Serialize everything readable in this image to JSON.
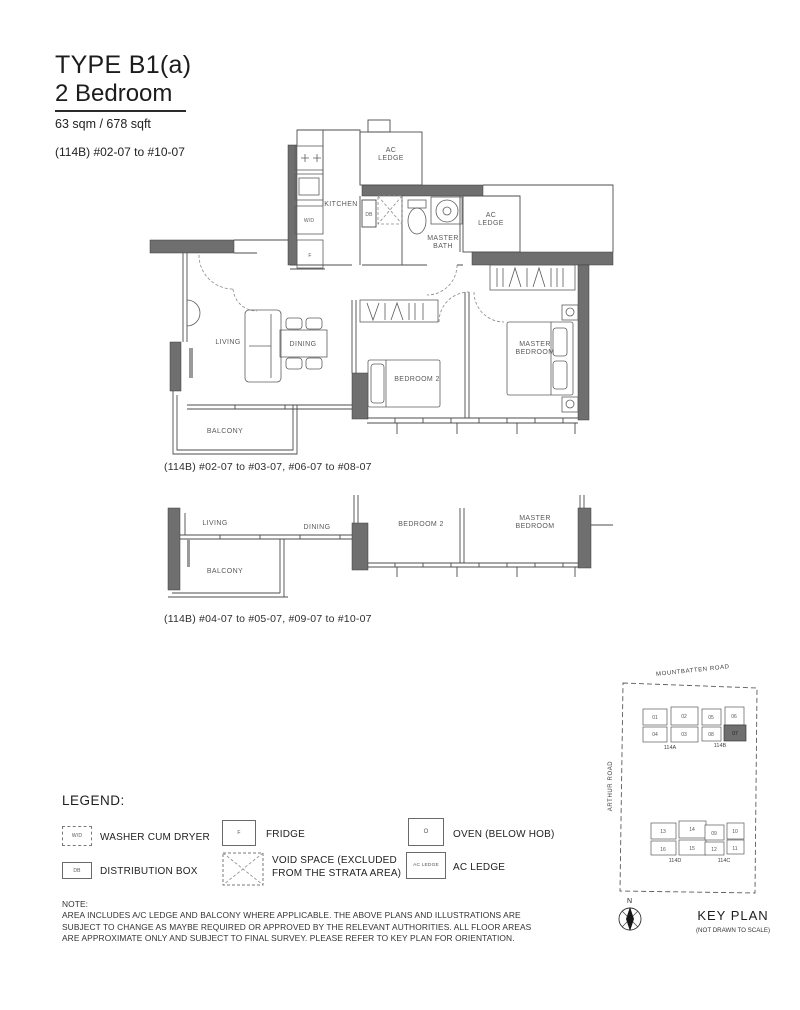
{
  "header": {
    "type_title": "TYPE B1(a)",
    "subtitle": "2 Bedroom",
    "area": "63 sqm / 678 sqft",
    "units": "(114B) #02-07 to #10-07"
  },
  "plan_main": {
    "labels": {
      "kitchen": "KITCHEN",
      "ac_ledge_top": "AC\nLEDGE",
      "master_bath": "MASTER\nBATH",
      "ac_ledge_right": "AC\nLEDGE",
      "living": "LIVING",
      "dining": "DINING",
      "bedroom2": "BEDROOM 2",
      "master_bedroom": "MASTER\nBEDROOM",
      "balcony": "BALCONY"
    },
    "fixtures": {
      "wd": "W/D",
      "fridge": "F",
      "db": "DB"
    },
    "caption": "(114B) #02-07 to #03-07, #06-07 to #08-07"
  },
  "plan_alt": {
    "labels": {
      "living": "LIVING",
      "dining": "DINING",
      "bedroom2": "BEDROOM 2",
      "master_bedroom": "MASTER\nBEDROOM",
      "balcony": "BALCONY"
    },
    "caption": "(114B) #04-07 to #05-07, #09-07 to #10-07"
  },
  "legend": {
    "title": "LEGEND:",
    "items": [
      {
        "symbol": "W/D",
        "label": "WASHER CUM DRYER"
      },
      {
        "symbol": "F",
        "label": "FRIDGE"
      },
      {
        "symbol": "O",
        "label": "OVEN (BELOW HOB)"
      },
      {
        "symbol": "DB",
        "label": "DISTRIBUTION BOX"
      },
      {
        "symbol": "",
        "label": "VOID SPACE (EXCLUDED\nFROM THE STRATA AREA)"
      },
      {
        "symbol": "AC LEDGE",
        "label": "AC LEDGE"
      }
    ]
  },
  "note": {
    "heading": "NOTE:",
    "body": "AREA INCLUDES A/C LEDGE AND BALCONY WHERE APPLICABLE. THE ABOVE PLANS AND ILLUSTRATIONS ARE\nSUBJECT TO CHANGE AS MAYBE REQUIRED OR APPROVED BY THE RELEVANT AUTHORITIES. ALL FLOOR AREAS\nARE APPROXIMATE ONLY AND SUBJECT TO FINAL SURVEY. PLEASE REFER TO KEY PLAN FOR ORIENTATION."
  },
  "key_plan": {
    "road_top": "MOUNTBATTEN ROAD",
    "road_left": "ARTHUR ROAD",
    "compass_n": "N",
    "title": "KEY PLAN",
    "subtitle": "(NOT DRAWN TO SCALE)",
    "highlighted_unit": "07",
    "blocks": [
      {
        "name": "114A",
        "units": [
          "01",
          "02",
          "04",
          "03"
        ]
      },
      {
        "name": "114B",
        "units": [
          "05",
          "06",
          "08",
          "07"
        ]
      },
      {
        "name": "114D",
        "units": [
          "13",
          "14",
          "16",
          "15"
        ]
      },
      {
        "name": "114C",
        "units": [
          "09",
          "10",
          "12",
          "11"
        ]
      }
    ]
  },
  "colors": {
    "wall": "#6f6f6f",
    "line": "#4d4d4d",
    "label": "#5a5a5a",
    "text": "#1c1c1c"
  }
}
